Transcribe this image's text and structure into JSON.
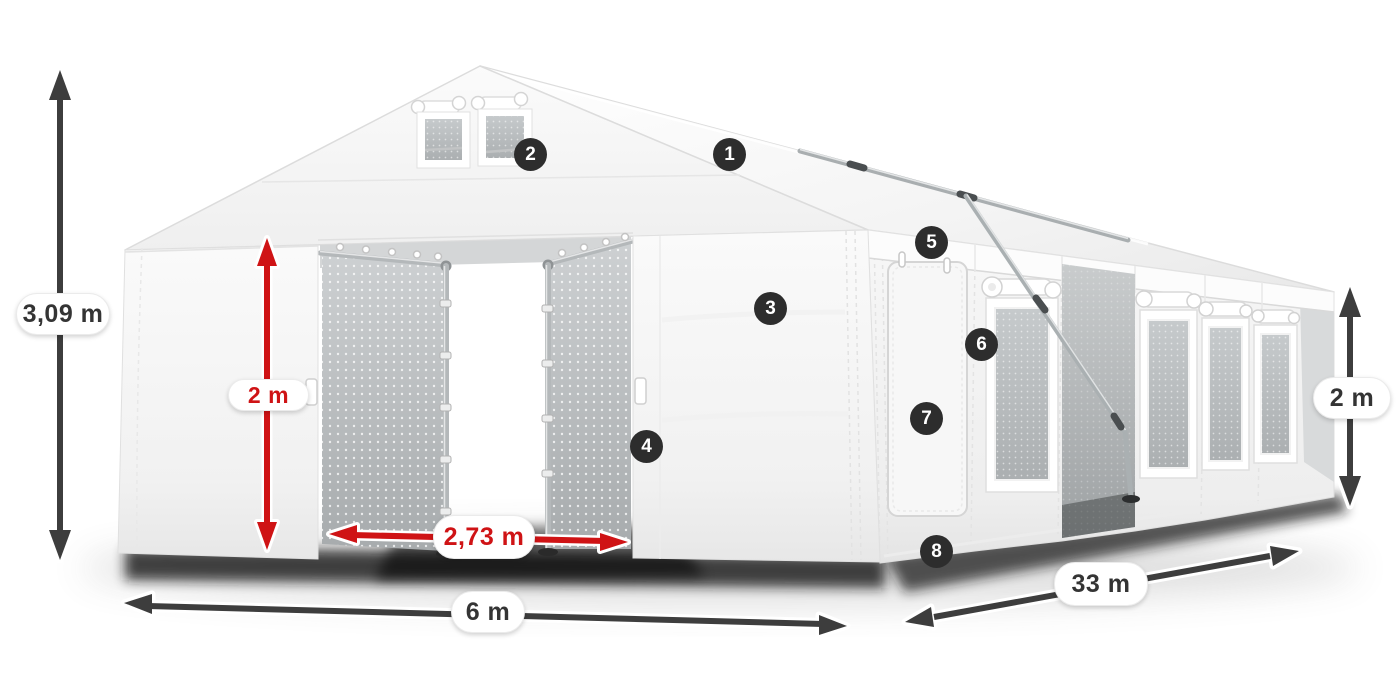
{
  "diagram": {
    "background": "#ffffff",
    "kind": "tent-dimension-diagram"
  },
  "dimensions": {
    "total_height": {
      "label": "3,09 m",
      "style": "dark",
      "orientation": "vertical"
    },
    "entrance_height": {
      "label": "2 m",
      "style": "red",
      "orientation": "vertical"
    },
    "entrance_width": {
      "label": "2,73 m",
      "style": "red",
      "orientation": "horizontal"
    },
    "width": {
      "label": "6 m",
      "style": "dark",
      "orientation": "horizontal"
    },
    "length": {
      "label": "33 m",
      "style": "dark",
      "orientation": "diagonal"
    },
    "wall_height": {
      "label": "2 m",
      "style": "dark",
      "orientation": "vertical"
    }
  },
  "callouts": [
    {
      "number": "1",
      "target": "roof"
    },
    {
      "number": "2",
      "target": "gable-vent-windows"
    },
    {
      "number": "3",
      "target": "front-wall-panel"
    },
    {
      "number": "4",
      "target": "entrance-edge"
    },
    {
      "number": "5",
      "target": "eave-valance"
    },
    {
      "number": "6",
      "target": "side-window"
    },
    {
      "number": "7",
      "target": "side-door"
    },
    {
      "number": "8",
      "target": "ground-skirt"
    }
  ],
  "colors": {
    "dimension_red": "#cf1315",
    "dimension_dark": "#3d3d3d",
    "badge_background": "#2d2d2d",
    "badge_text": "#ffffff",
    "label_background": "#ffffff",
    "label_text": "#343434",
    "tent_white": "#f8f8f8",
    "mesh_gray": "#b9bdbf"
  }
}
